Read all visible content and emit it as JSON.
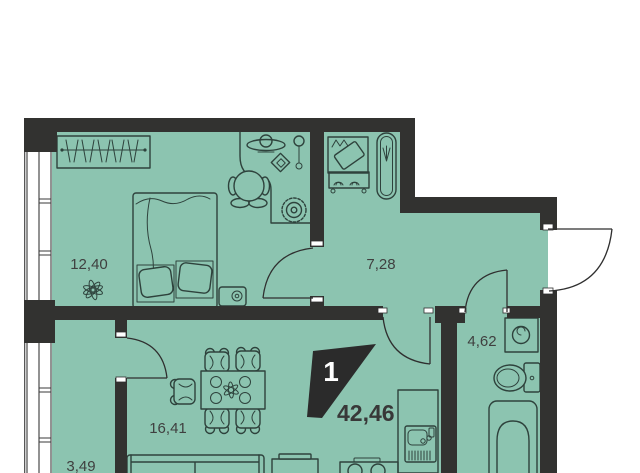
{
  "floor_plan": {
    "badge": {
      "rooms_count": "1",
      "total_area": "42,46"
    },
    "areas": {
      "bedroom": "12,40",
      "hallway": "7,28",
      "bathroom": "4,62",
      "living_kitchen": "16,41",
      "balcony": "3,49"
    },
    "colors": {
      "room_fill": "#8cc4b0",
      "wall": "#323230",
      "line": "#2e423c",
      "label": "#3f3f3f",
      "badge_bg": "#2b2b2b",
      "badge_text": "#ffffff",
      "outside": "#ffffff"
    }
  }
}
